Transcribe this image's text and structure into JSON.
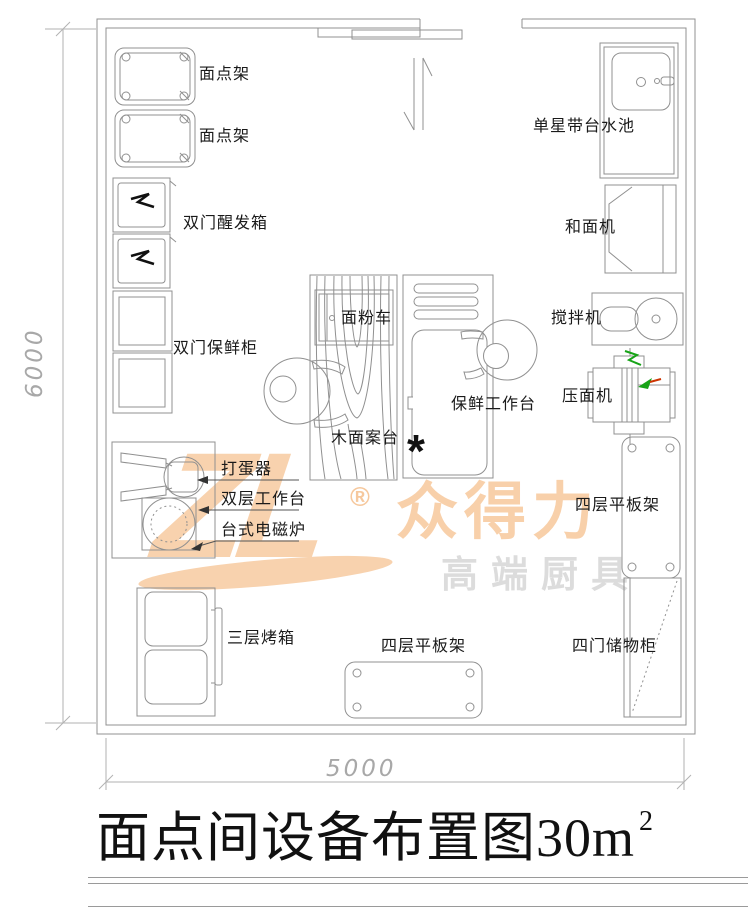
{
  "title": {
    "main": "面点间设备布置图",
    "area": "30m",
    "sup": "2"
  },
  "dimensions": {
    "bottom": "5000",
    "left": "6000"
  },
  "labels": {
    "rack1": "面点架",
    "rack2": "面点架",
    "proofer": "双门醒发箱",
    "fresh_cabinet": "双门保鲜柜",
    "egg_beater": "打蛋器",
    "double_worktable": "双层工作台",
    "induction": "台式电磁炉",
    "oven": "三层烤箱",
    "flat_rack_bottom": "四层平板架",
    "storage": "四门储物柜",
    "flat_rack_right": "四层平板架",
    "dough_press": "压面机",
    "mixer": "搅拌机",
    "dough_mixer": "和面机",
    "sink": "单星带台水池",
    "flour_cart": "面粉车",
    "wood_table": "木面案台",
    "fresh_worktable": "保鲜工作台",
    "star": "*"
  },
  "watermark": {
    "logo": "ZL",
    "reg": "®",
    "brand": "众得力",
    "tagline": "高端厨具"
  },
  "colors": {
    "line": "#909090",
    "text": "#1a1a1a",
    "dim": "#a8a8a8",
    "wm_orange": "#f8d2ae",
    "wm_gray": "#dcdcdc",
    "accent_green": "#17a317",
    "accent_red": "#cc3300"
  }
}
